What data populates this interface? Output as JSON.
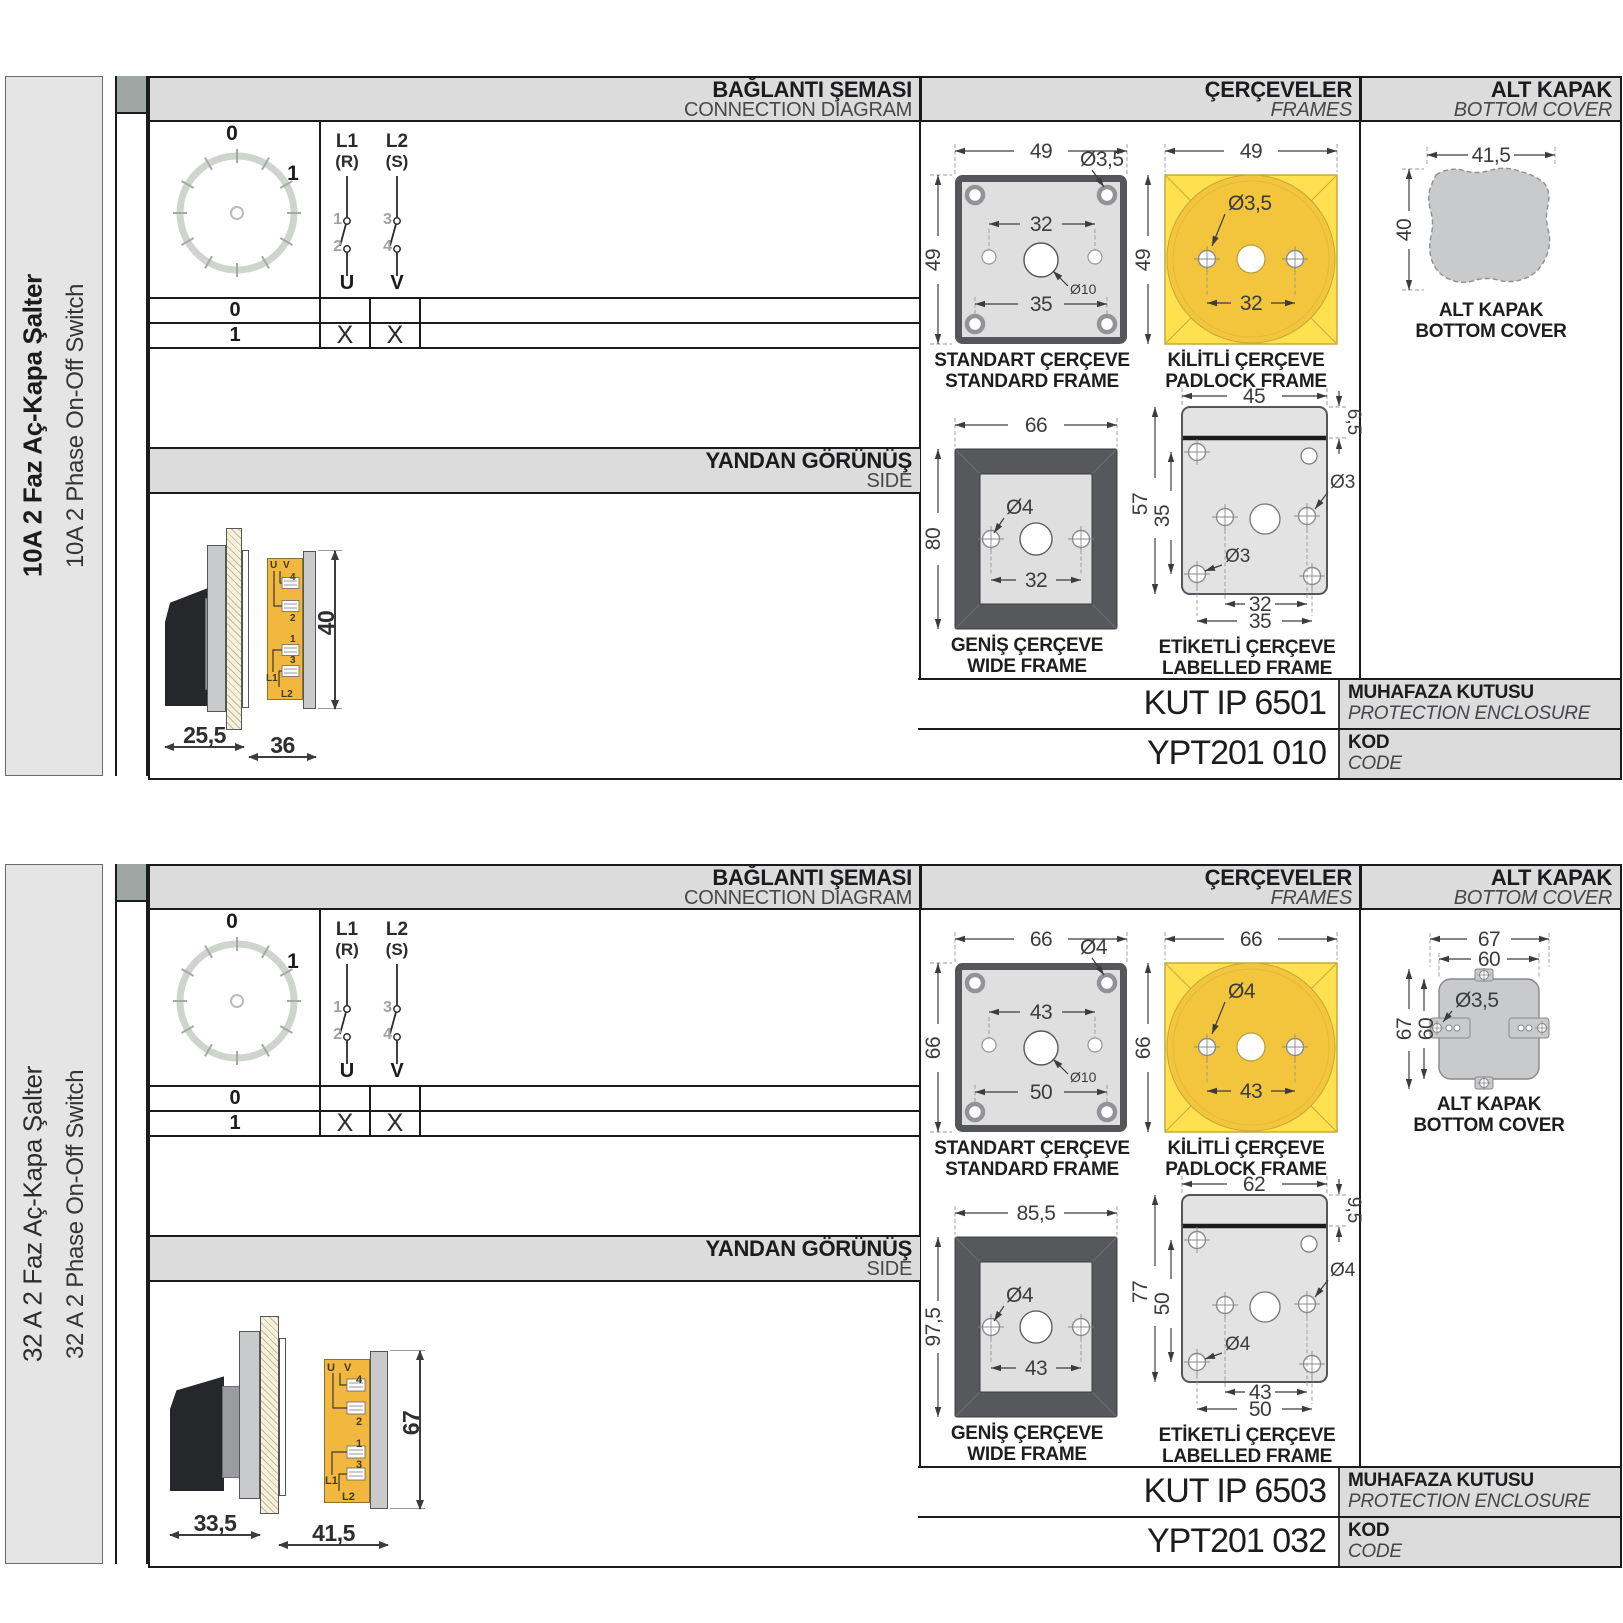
{
  "shared": {
    "headers": {
      "connection_tr": "BAĞLANTI ŞEMASI",
      "connection_en": "CONNECTION DIAGRAM",
      "frames_tr": "ÇERÇEVELER",
      "frames_en": "FRAMES",
      "cover_tr": "ALT KAPAK",
      "cover_en": "BOTTOM COVER",
      "side_tr": "YANDAN GÖRÜNÜŞ",
      "side_en": "SIDE"
    },
    "dial": {
      "pos0": "0",
      "pos1": "1"
    },
    "poles": {
      "p1_line": "L1",
      "p1_phase": "(R)",
      "p1_top": "1",
      "p1_bot": "2",
      "p1_out": "U",
      "p2_line": "L2",
      "p2_phase": "(S)",
      "p2_top": "3",
      "p2_bot": "4",
      "p2_out": "V"
    },
    "table": {
      "r0": "0",
      "r1": "1",
      "r0_u": "",
      "r0_v": "",
      "r1_u": "X",
      "r1_v": "X"
    },
    "terminals": {
      "u": "U",
      "v": "V",
      "n4": "4",
      "n2": "2",
      "n1": "1",
      "n3": "3",
      "l1": "L1",
      "l2": "L2"
    },
    "captions": {
      "standard_tr": "STANDART ÇERÇEVE",
      "standard_en": "STANDARD FRAME",
      "padlock_tr": "KİLİTLİ ÇERÇEVE",
      "padlock_en": "PADLOCK FRAME",
      "wide_tr": "GENİŞ ÇERÇEVE",
      "wide_en": "WIDE FRAME",
      "labelled_tr": "ETİKETLİ ÇERÇEVE",
      "labelled_en": "LABELLED FRAME",
      "cover_tr": "ALT KAPAK",
      "cover_en": "BOTTOM COVER"
    },
    "code_labels": {
      "enclosure_tr": "MUHAFAZA KUTUSU",
      "enclosure_en": "PROTECTION ENCLOSURE",
      "code_tr": "KOD",
      "code_en": "CODE"
    },
    "colors": {
      "padlock_yellow": "#FFE14F",
      "padlock_circle": "#F2C53C",
      "switch_body_yellow": "#F1B73E",
      "frame_dark": "#57585B",
      "panel_gray": "#DCDCDD"
    }
  },
  "sections": [
    {
      "title_tr": "10A 2 Faz Aç-Kapa Şalter",
      "title_en": "10A 2 Phase On-Off Switch",
      "side": {
        "depth": "25,5",
        "length": "36",
        "height": "40"
      },
      "standard": {
        "w": "49",
        "h": "49",
        "hole": "Ø3,5",
        "span": "32",
        "center": "Ø10",
        "mount_span": "35"
      },
      "padlock": {
        "w": "49",
        "h": "49",
        "hole": "Ø3,5",
        "span": "32"
      },
      "wide": {
        "w": "66",
        "h": "80",
        "hole": "Ø4",
        "span": "32"
      },
      "labelled": {
        "w": "45",
        "tab": "6,5",
        "h": "57",
        "span_v": "35",
        "hole_r": "Ø3",
        "hole_b": "Ø3",
        "span_b1": "32",
        "span_b2": "35"
      },
      "cover": {
        "w": "41,5",
        "h": "40"
      },
      "enclosure_code": "KUT IP 6501",
      "code": "YPT201 010"
    },
    {
      "title_tr": "32 A 2 Faz Aç-Kapa Şalter",
      "title_en": "32 A 2 Phase On-Off Switch",
      "side": {
        "depth": "33,5",
        "length": "41,5",
        "height": "67"
      },
      "standard": {
        "w": "66",
        "h": "66",
        "hole": "Ø4",
        "span": "43",
        "center": "Ø10",
        "mount_span": "50"
      },
      "padlock": {
        "w": "66",
        "h": "66",
        "hole": "Ø4",
        "span": "43"
      },
      "wide": {
        "w": "85,5",
        "h": "97,5",
        "hole": "Ø4",
        "span": "43"
      },
      "labelled": {
        "w": "62",
        "tab": "9,5",
        "h": "77",
        "span_v": "50",
        "hole_r": "Ø4",
        "hole_b": "Ø4",
        "span_b1": "43",
        "span_b2": "50"
      },
      "cover": {
        "w": "67",
        "w2": "60",
        "h": "67",
        "h2": "60",
        "hole": "Ø3,5"
      },
      "enclosure_code": "KUT IP 6503",
      "code": "YPT201 032"
    }
  ]
}
